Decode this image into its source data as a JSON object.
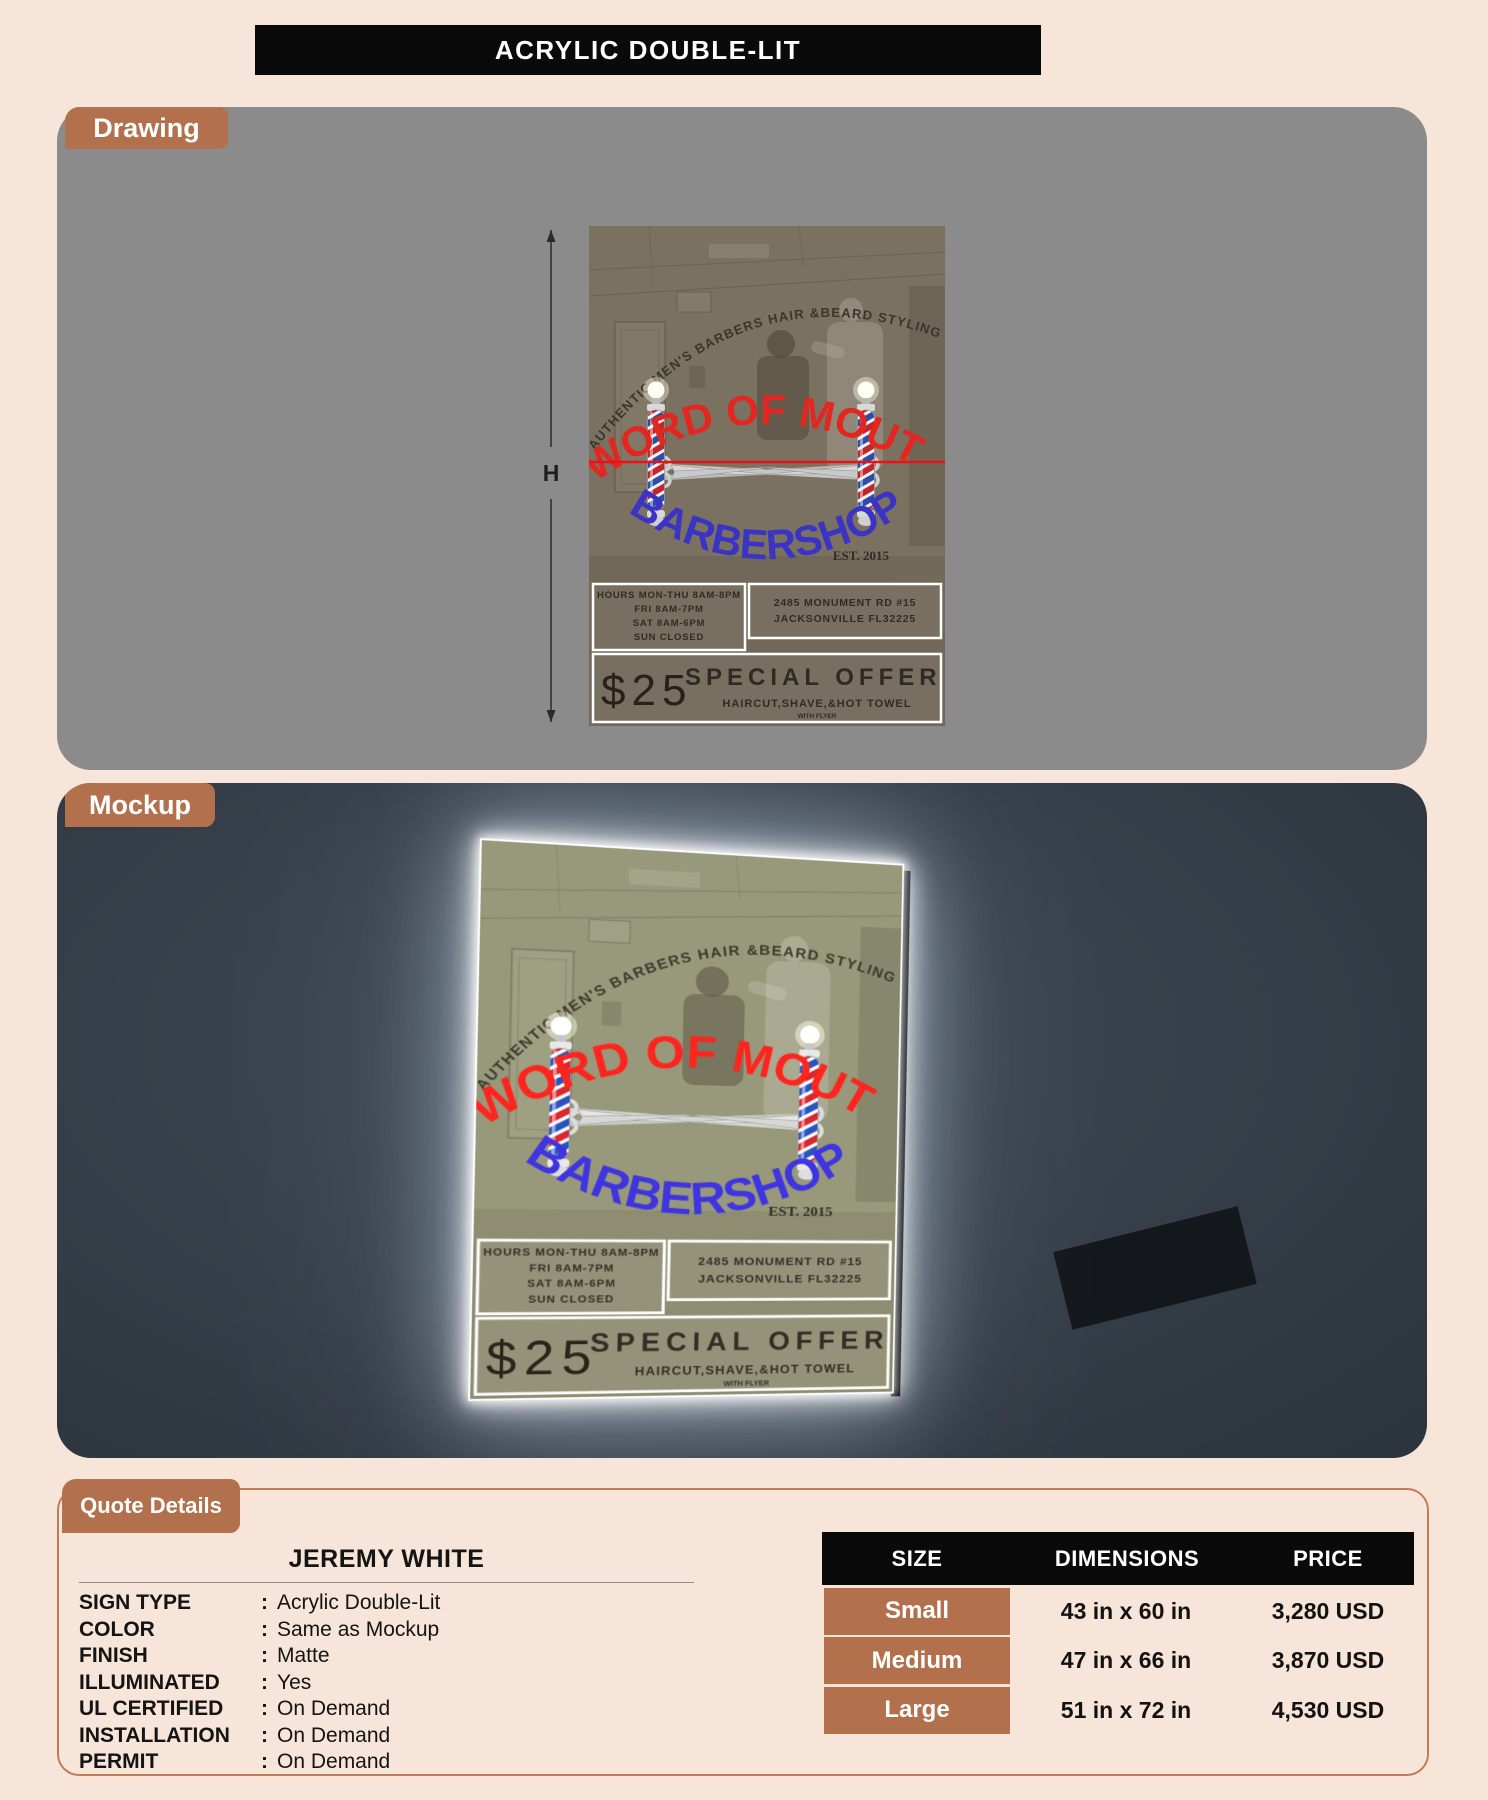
{
  "header": {
    "title": "ACRYLIC DOUBLE-LIT"
  },
  "sections": {
    "drawing_label": "Drawing",
    "mockup_label": "Mockup",
    "quote_label": "Quote Details"
  },
  "dimension_labels": {
    "width": "W",
    "height": "H"
  },
  "sign": {
    "arch_text": "AUTHENTIC MEN'S BARBERS HAIR &BEARD STYLING",
    "title_line1": "WORD OF MOUTH",
    "title_line2": "BARBERSHOP",
    "established": "EST. 2015",
    "hours": [
      "HOURS MON-THU 8AM-8PM",
      "FRI 8AM-7PM",
      "SAT 8AM-6PM",
      "SUN CLOSED"
    ],
    "address": [
      "2485 MONUMENT RD #15",
      "JACKSONVILLE FL32225"
    ],
    "offer": {
      "price": "$25",
      "title": "SPECIAL OFFER",
      "subtitle": "HAIRCUT,SHAVE,&HOT TOWEL",
      "note": "WITH FLYER"
    }
  },
  "quote": {
    "customer_name": "JEREMY WHITE",
    "separator": ":",
    "specs": [
      {
        "label": "SIGN TYPE",
        "value": "Acrylic Double-Lit"
      },
      {
        "label": "COLOR",
        "value": "Same as Mockup"
      },
      {
        "label": "FINISH",
        "value": "Matte"
      },
      {
        "label": "ILLUMINATED",
        "value": "Yes"
      },
      {
        "label": "UL CERTIFIED",
        "value": "On Demand"
      },
      {
        "label": "INSTALLATION",
        "value": "On Demand"
      },
      {
        "label": "PERMIT",
        "value": "On Demand"
      }
    ],
    "table": {
      "headers": [
        "SIZE",
        "DIMENSIONS",
        "PRICE"
      ],
      "rows": [
        {
          "size": "Small",
          "dimensions": "43 in x 60 in",
          "price": "3,280 USD"
        },
        {
          "size": "Medium",
          "dimensions": "47 in x 66 in",
          "price": "3,870 USD"
        },
        {
          "size": "Large",
          "dimensions": "51 in x 72 in",
          "price": "4,530 USD"
        }
      ]
    }
  },
  "colors": {
    "accent_brown": "#b2704c",
    "panel_gray": "#8b8b8b",
    "panel_dark": "#343d47",
    "header_black": "#0a0a0a",
    "page_background": "#f7e5da",
    "sign_red": "#e32620",
    "sign_blue": "#3b33c4"
  }
}
